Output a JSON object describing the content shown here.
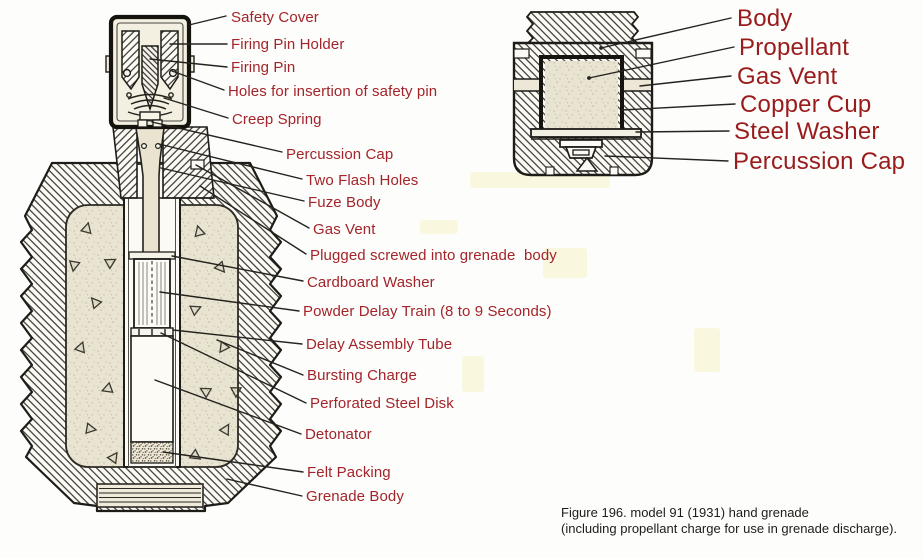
{
  "figure": {
    "caption_line1": "Figure 196. model 91 (1931) hand grenade",
    "caption_line2": "(including propellant charge for use in grenade discharge)."
  },
  "colors": {
    "label_red_left": "#a3242a",
    "label_red_right": "#991b1b",
    "ink": "#24231e",
    "filling_beige": "#e9e4d1",
    "background": "#fdfdfb"
  },
  "left_labels": {
    "safety_cover": "Safety Cover",
    "firing_pin_holder": "Firing Pin Holder",
    "firing_pin": "Firing Pin",
    "safety_pin_holes": "Holes for insertion of safety pin",
    "creep_spring": "Creep Spring",
    "percussion_cap": "Percussion Cap",
    "two_flash_holes": "Two Flash Holes",
    "fuze_body": "Fuze Body",
    "gas_vent": "Gas Vent",
    "plug": "Plugged screwed into grenade  body",
    "cardboard_washer": "Cardboard Washer",
    "powder_delay_train": "Powder Delay Train (8 to 9 Seconds)",
    "delay_assembly_tube": "Delay Assembly Tube",
    "bursting_charge": "Bursting Charge",
    "perforated_steel_disk": "Perforated Steel Disk",
    "detonator": "Detonator",
    "felt_packing": "Felt Packing",
    "grenade_body": "Grenade Body"
  },
  "right_labels": {
    "body": "Body",
    "propellant": "Propellant",
    "gas_vent": "Gas Vent",
    "copper_cup": "Copper Cup",
    "steel_washer": "Steel Washer",
    "percussion_cap": "Percussion Cap"
  }
}
